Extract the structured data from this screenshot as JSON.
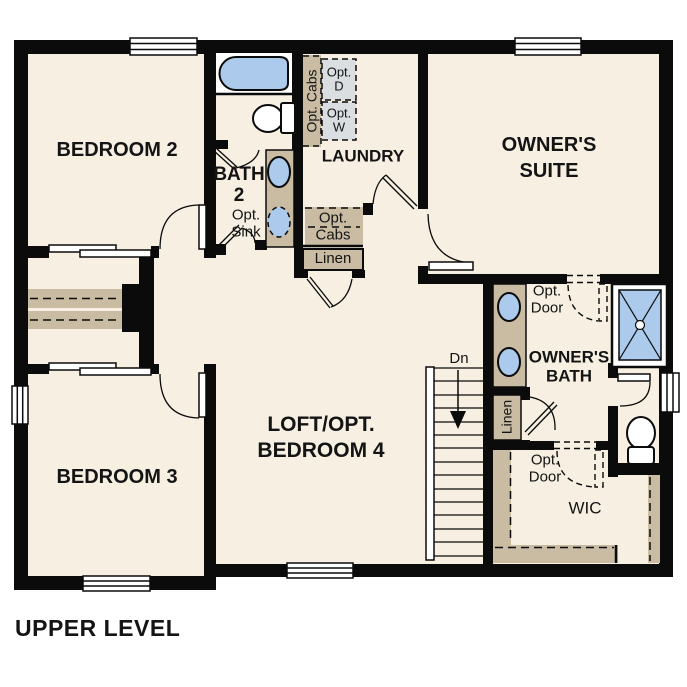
{
  "plan_title": "UPPER LEVEL",
  "colors": {
    "floor": "#f6efe2",
    "wall": "#0b0b0b",
    "cabinet_tan": "#c9bca3",
    "fixture_blue": "#abcaec",
    "appliance_gray": "#dbdee1"
  },
  "rooms": {
    "bedroom2": "BEDROOM 2",
    "bath2": [
      "BATH",
      "2"
    ],
    "laundry": "LAUNDRY",
    "owners_suite": [
      "OWNER'S",
      "SUITE"
    ],
    "bedroom3": "BEDROOM 3",
    "loft": [
      "LOFT/OPT.",
      "BEDROOM 4"
    ],
    "owners_bath": [
      "OWNER'S",
      "BATH"
    ],
    "wic": "WIC"
  },
  "features": {
    "opt_cabs_wall": "Opt. Cabs",
    "opt_dryer": [
      "Opt.",
      "D"
    ],
    "opt_washer": [
      "Opt.",
      "W"
    ],
    "opt_sink": [
      "Opt.",
      "Sink"
    ],
    "opt_cabs_base": [
      "Opt.",
      "Cabs"
    ],
    "linen_hall": "Linen",
    "linen_owners": "Linen",
    "opt_door_suite": [
      "Opt.",
      "Door"
    ],
    "opt_door_wic": [
      "Opt.",
      "Door"
    ],
    "stairs_down": "Dn"
  }
}
